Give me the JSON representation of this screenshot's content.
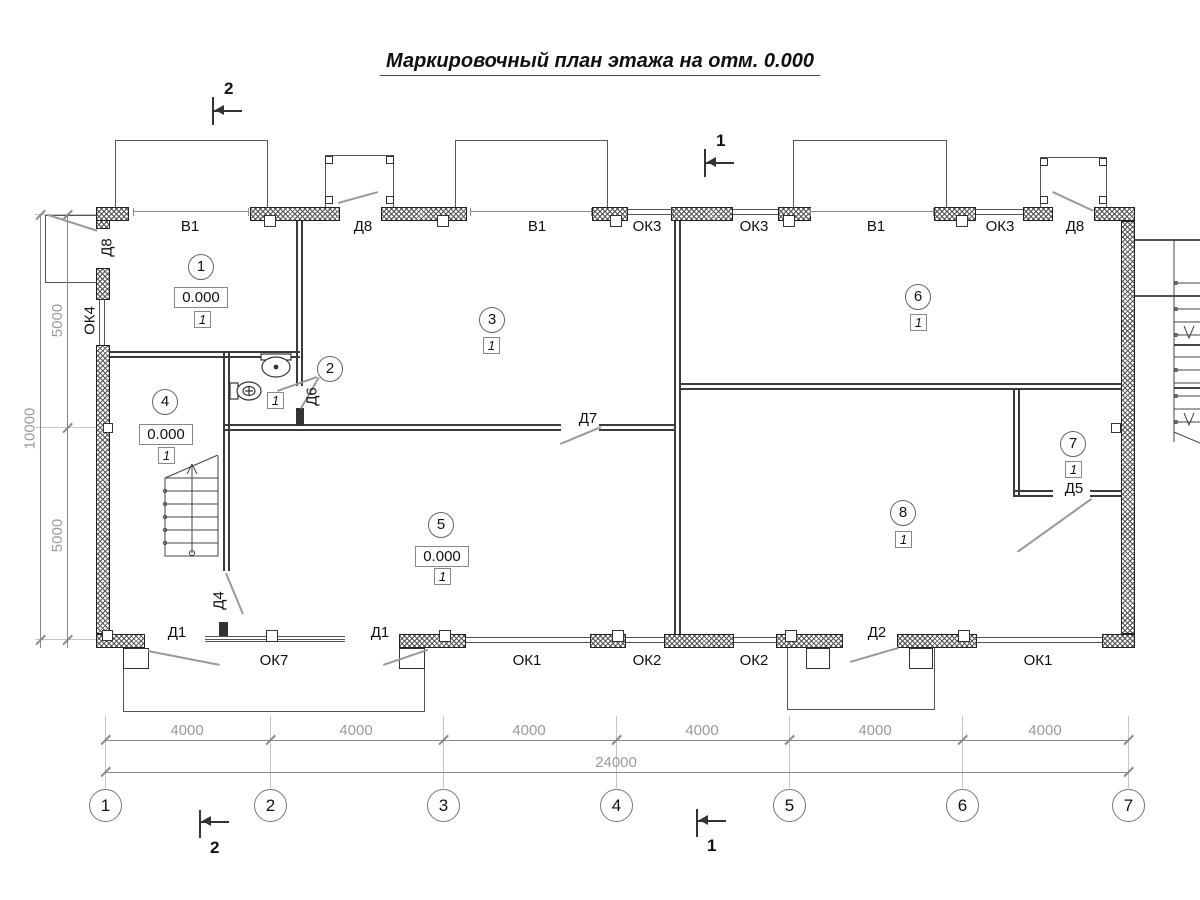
{
  "title": "Маркировочный план этажа на отм. 0.000",
  "labels": {
    "top": [
      "В1",
      "Д8",
      "В1",
      "ОК3",
      "ОК3",
      "В1",
      "ОК3",
      "Д8"
    ],
    "bottom": [
      "Д1",
      "ОК7",
      "Д1",
      "ОК1",
      "ОК2",
      "ОК2",
      "Д2",
      "ОК1"
    ],
    "left": [
      "Д8",
      "ОК4"
    ],
    "doors": [
      "Д6",
      "Д7",
      "Д4",
      "Д5"
    ]
  },
  "rooms": [
    {
      "num": "1",
      "elev": "0.000",
      "finish": "1"
    },
    {
      "num": "2",
      "finish": "1"
    },
    {
      "num": "3",
      "finish": "1"
    },
    {
      "num": "4",
      "elev": "0.000",
      "finish": "1"
    },
    {
      "num": "5",
      "elev": "0.000",
      "finish": "1"
    },
    {
      "num": "6",
      "finish": "1"
    },
    {
      "num": "7",
      "finish": "1"
    },
    {
      "num": "8",
      "finish": "1"
    }
  ],
  "dims": {
    "h": [
      "4000",
      "4000",
      "4000",
      "4000",
      "4000",
      "4000"
    ],
    "total": "24000",
    "v": [
      "5000",
      "5000"
    ],
    "vtotal": "10000"
  },
  "axes": [
    "1",
    "2",
    "3",
    "4",
    "5",
    "6",
    "7"
  ],
  "sections": {
    "tl": "2",
    "tr": "1",
    "bl": "2",
    "br": "1"
  }
}
